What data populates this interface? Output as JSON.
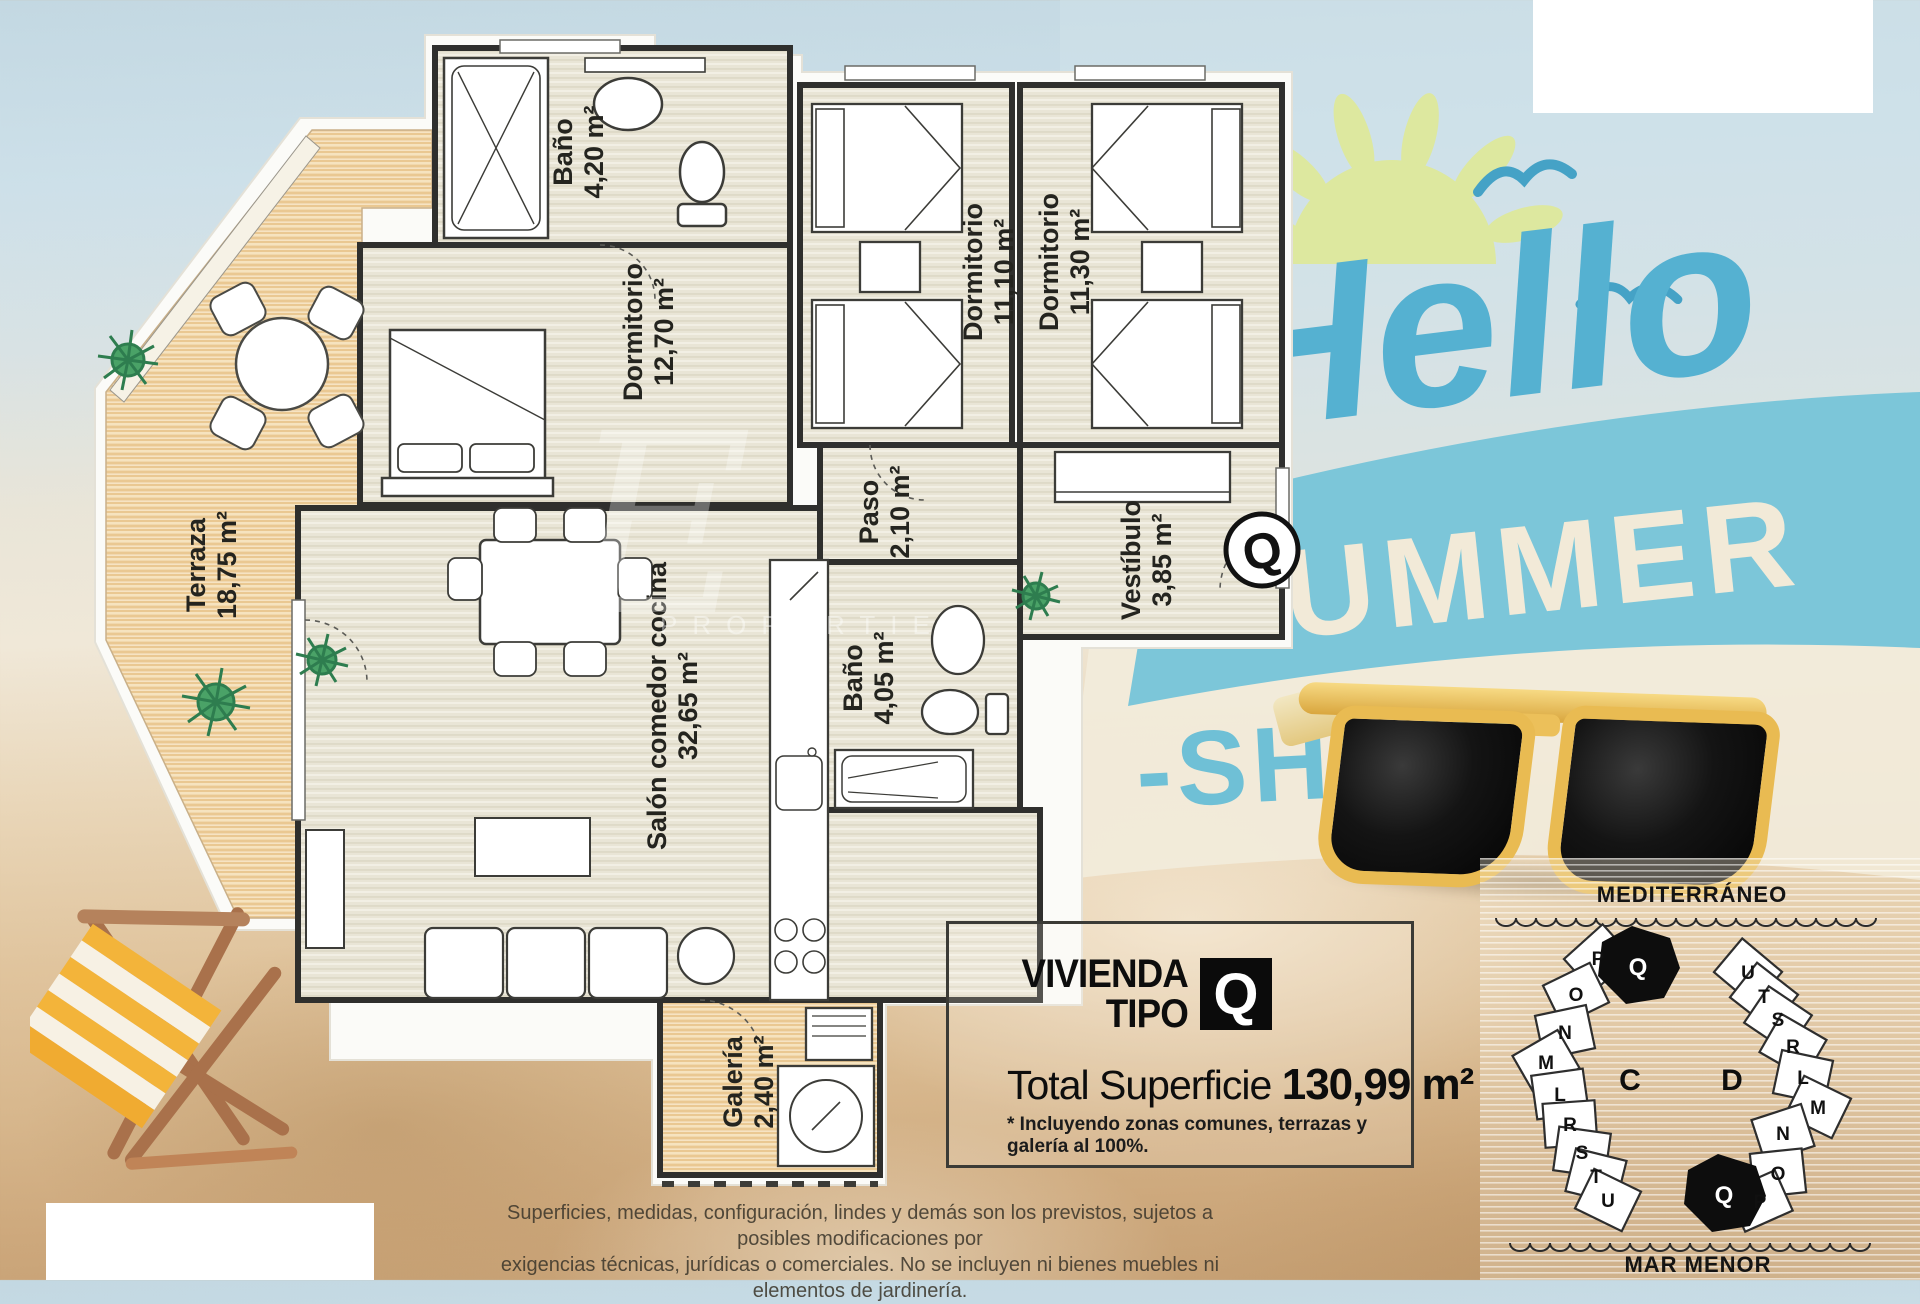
{
  "promo": {
    "hello": "Hello",
    "summer": "SUMMER",
    "shine": "-SHINE"
  },
  "floor_plan": {
    "unit_badge": "Q",
    "rooms": [
      {
        "name": "Baño",
        "area": "4,20 m²"
      },
      {
        "name": "Dormitorio",
        "area": "12,70 m²"
      },
      {
        "name": "Dormitorio",
        "area": "11,10 m²"
      },
      {
        "name": "Dormitorio",
        "area": "11,30 m²"
      },
      {
        "name": "Paso",
        "area": "2,10 m²"
      },
      {
        "name": "Vestíbulo",
        "area": "3,85 m²"
      },
      {
        "name": "Baño",
        "area": "4,05 m²"
      },
      {
        "name": "Salón comedor cocina",
        "area": "32,65 m²"
      },
      {
        "name": "Galería",
        "area": "2,40 m²"
      },
      {
        "name": "Terraza",
        "area": "18,75 m²"
      }
    ]
  },
  "info_box": {
    "title_line1": "VIVIENDA",
    "title_line2": "TIPO",
    "type_letter": "Q",
    "total_label": "Total Superficie",
    "total_value": "130,99 m²",
    "footnote": "* Incluyendo zonas comunes, terrazas y galería al 100%."
  },
  "site_plan": {
    "sea_top": "MEDITERRÁNEO",
    "sea_bottom": "MAR MENOR",
    "building_c": {
      "label": "C",
      "highlight": "Q",
      "units": [
        "P",
        "O",
        "N",
        "M",
        "L",
        "R",
        "S",
        "T",
        "U"
      ]
    },
    "building_d": {
      "label": "D",
      "highlight": "Q",
      "units": [
        "U",
        "T",
        "S",
        "R",
        "L",
        "M",
        "N",
        "O",
        "P"
      ]
    }
  },
  "disclaimer": {
    "line1": "Superficies, medidas, configuración, lindes y demás son los previstos, sujetos a posibles modificaciones por",
    "line2": "exigencias técnicas, jurídicas o comerciales. No se incluyen ni bienes muebles ni elementos de jardinería."
  },
  "watermark": {
    "letter": "E",
    "word": "PROPERTIES"
  },
  "colors": {
    "teal_script": "#55b1d1",
    "teal_band": "#7cc6d9",
    "cream_letters": "#f2ead8",
    "sun": "#dde89f",
    "sunglasses_frame": "#e9bb52",
    "wood": "#eac892",
    "wall": "#2f2f2d"
  }
}
